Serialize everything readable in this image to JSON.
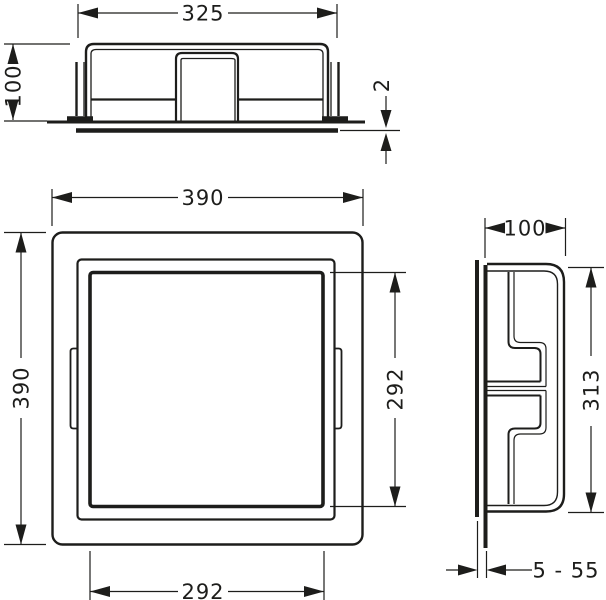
{
  "drawing": {
    "colors": {
      "line": "#1d1d1b",
      "background": "#ffffff"
    },
    "views": {
      "top": {
        "dims": {
          "width": "325",
          "height": "100",
          "flange_thickness": "2"
        }
      },
      "front": {
        "dims": {
          "outer_width": "390",
          "outer_height": "390",
          "opening_width": "292",
          "opening_height": "292"
        }
      },
      "side": {
        "dims": {
          "depth": "100",
          "height": "313",
          "mounting_depth_range": "5 - 55"
        }
      }
    }
  }
}
